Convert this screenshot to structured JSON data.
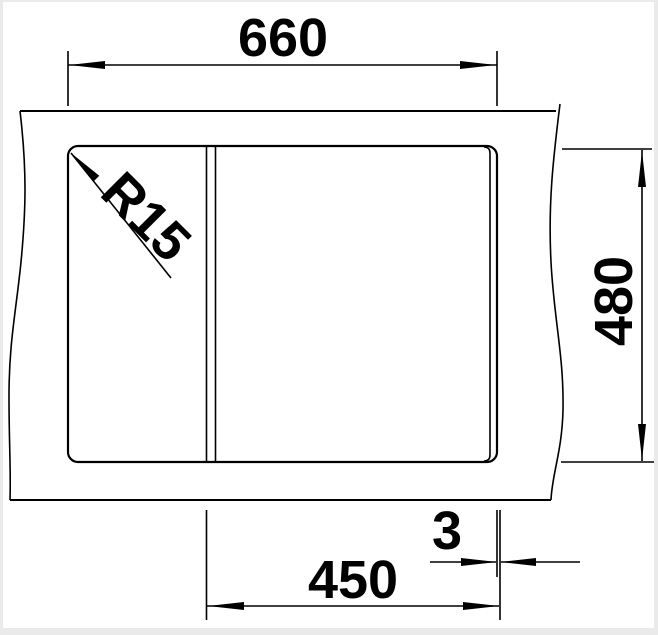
{
  "drawing": {
    "description": "Technical installation drawing of a sink cutout in a worktop, top view, with break lines on left and right",
    "background_color": "#ffffff",
    "line_color": "#000000",
    "frame_color": "#eaeaea",
    "labels": {
      "cutout_width": "660",
      "cutout_depth": "480",
      "bowl_section_width": "450",
      "edge_offset": "3",
      "corner_radius": "R15"
    }
  }
}
